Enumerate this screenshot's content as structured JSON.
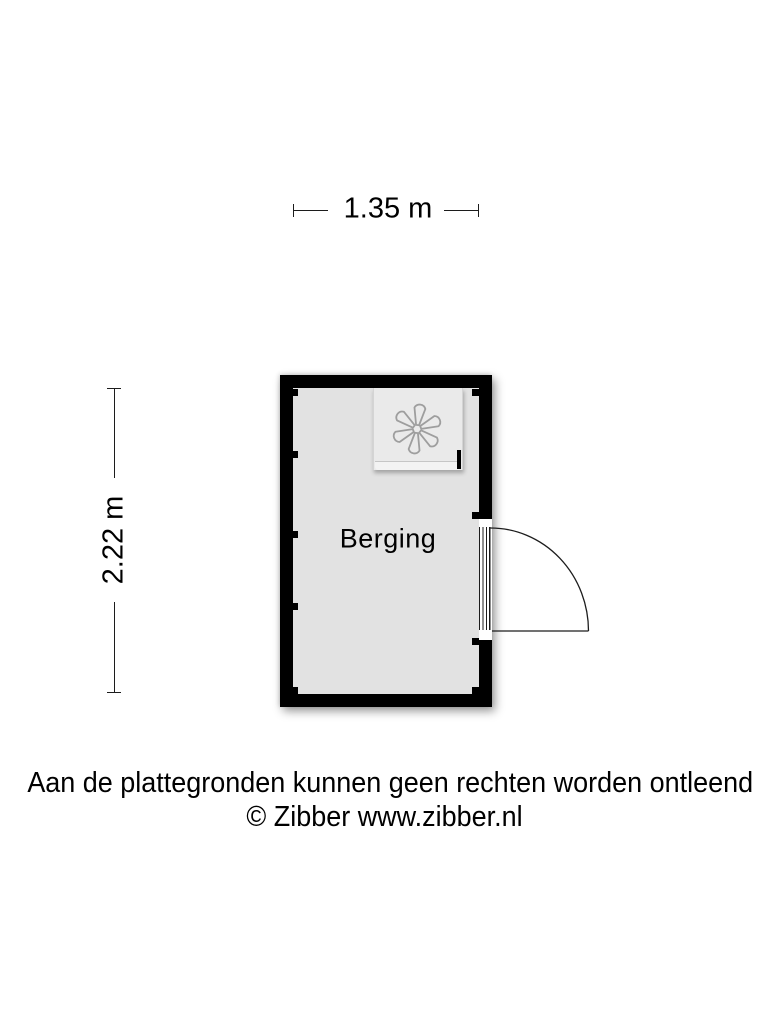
{
  "floorplan": {
    "room_label": "Berging",
    "width_label": "1.35 m",
    "height_label": "2.22 m",
    "fixtures": [
      {
        "name": "washing-machine",
        "icon": "fan-icon"
      }
    ],
    "door": {
      "wall": "right",
      "swing": "quarter-arc-outward"
    },
    "colors": {
      "wall": "#000000",
      "floor": "#e2e2e2",
      "machine-body": "#eaeaea",
      "machine-front": "#f3f3f3",
      "fan-stroke": "#9e9e9e",
      "line": "#1c1c1c",
      "text": "#000000",
      "background": "#ffffff"
    }
  },
  "footer": {
    "disclaimer": "Aan de plattegronden kunnen geen rechten worden ontleend",
    "copyright": "© Zibber www.zibber.nl"
  }
}
